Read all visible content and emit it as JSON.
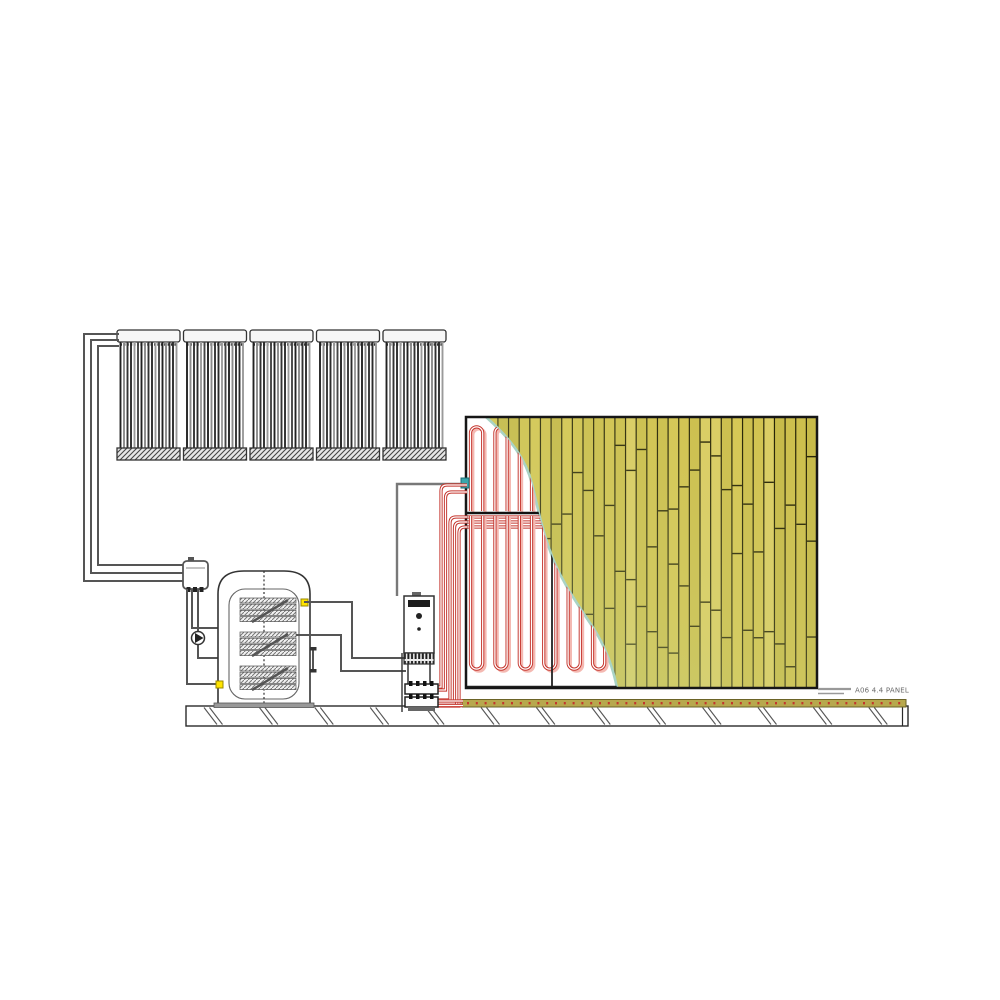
{
  "label": {
    "text": "A06 4.4 PANEL"
  },
  "colors": {
    "ink": "#2a2a2a",
    "pipe_gray": "#555555",
    "conduit_gray": "#787878",
    "pipe_red": "#c4342c",
    "pipe_red_shadow": "#f4b9b2",
    "bamboo_joint": "#262306",
    "bamboo_shades": [
      "#d6c754",
      "#cdbf4d",
      "#dbcd63",
      "#d2c350",
      "#c7ba49"
    ],
    "bamboo_tint": "#b9d49b",
    "cutaway_edge": "#a9d3c5",
    "wall_border": "#161616",
    "sensor_teal": "#3aa7ad",
    "connector_yellow": "#ffe400",
    "strip_fill": "#b7a84d",
    "strip_border": "#6b6327",
    "label_gray": "#6a6a6a",
    "leader_gray": "#999999",
    "ground_hatch": "#555555",
    "tank_outline": "#333333"
  },
  "diagram": {
    "collector_panels": 5,
    "collector_tubes_per_panel": 17,
    "tank_coils": 3,
    "manifold_circuits": 5
  }
}
